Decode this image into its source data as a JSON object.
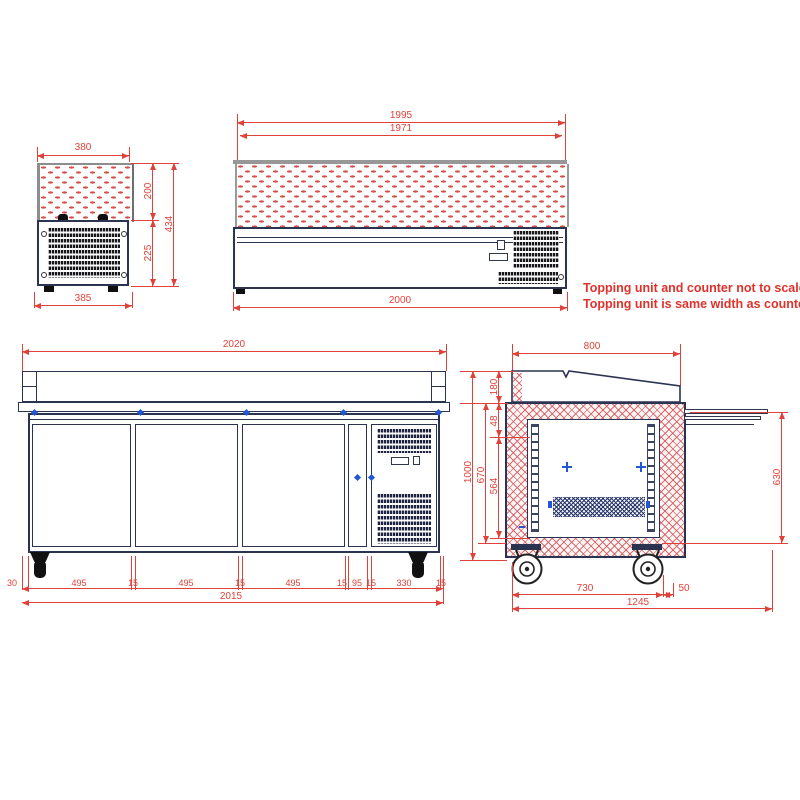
{
  "note": {
    "line1": "Topping unit and counter not to scale.",
    "line2": "Topping unit is same width as counter"
  },
  "dims": {
    "ts_top": "380",
    "ts_bottom": "385",
    "ts_glass": "200",
    "ts_base": "225",
    "ts_total": "434",
    "tf_outer": "1995",
    "tf_inner": "1971",
    "tf_base": "2000",
    "cf_top": "2020",
    "cf_total": "2015",
    "cf_seg": [
      "30",
      "495",
      "15",
      "495",
      "15",
      "495",
      "15",
      "95",
      "15",
      "330",
      "15"
    ],
    "cs_depth": "800",
    "cs_topping": "180",
    "cs_gap": "48",
    "cs_interior": "564",
    "cs_inner": "670",
    "cs_height": "1000",
    "cs_door": "630",
    "cs_wheelbase": "730",
    "cs_rear": "50",
    "cs_total": "1245"
  },
  "colors": {
    "dimension": "#e0423a",
    "outline": "#2a3350",
    "hatch": "#d4524b",
    "marker": "#2257d6"
  }
}
